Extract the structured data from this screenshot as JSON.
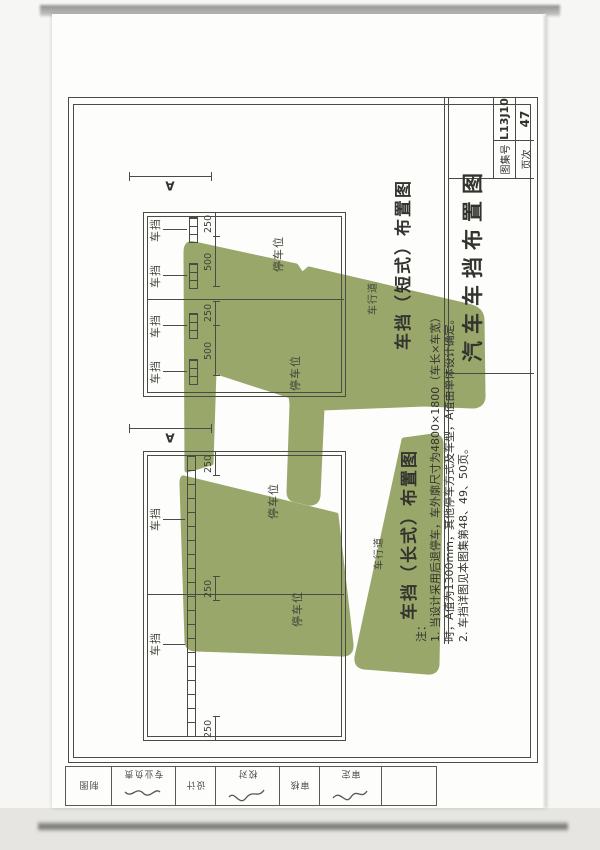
{
  "colors": {
    "watermark": "#95a466",
    "line": "#4b4b46",
    "paper": "#fdfdfb"
  },
  "title_block": {
    "title": "汽车车挡布置图",
    "atlas_label": "图集号",
    "atlas_no": "L13J10",
    "page_label": "页次",
    "page_no": "47"
  },
  "drawing_a": {
    "caption": "车挡（短式）布置图",
    "bay_label": "停车位",
    "lane_label": "车行道",
    "stop_label": "车挡",
    "dim_letter": "A",
    "dim_500": "500",
    "dim_250": "250"
  },
  "drawing_b": {
    "caption": "车挡（长式）布置图",
    "bay_label": "停车位",
    "lane_label": "车行道",
    "stop_label": "车挡",
    "dim_letter": "A",
    "dim_250": "250"
  },
  "notes": {
    "heading": "注：",
    "line1": "1. 当设计采用后退停车，车外廓尺寸为4800×1800（车长×车宽）",
    "line2": "时，A值为1300mm，其他停车方式及车型，A值由单体设计确定。",
    "line3": "2. 车挡详图见本图集第48、49、50页。"
  },
  "stamp_strip": {
    "cells": [
      {
        "label": ""
      },
      {
        "label": "审定"
      },
      {
        "label": "审核"
      },
      {
        "label": "校对"
      },
      {
        "label": "设计"
      },
      {
        "label": "专业负责"
      },
      {
        "label": "制图"
      }
    ]
  }
}
